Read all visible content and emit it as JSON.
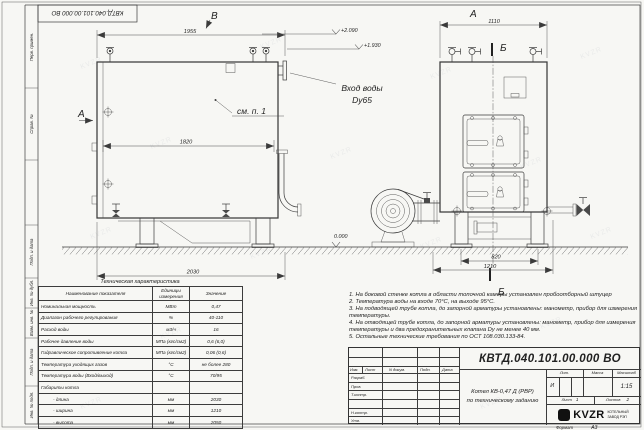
{
  "sheet": {
    "stamp_code": "КВТД.040.101.00.000 ВО",
    "format_label": "Формат",
    "format_value": "А3",
    "watermark": "KVZR",
    "margin_labels": {
      "perv_primen": "Перв. примен.",
      "sprav_no": "Справ. №",
      "podp_data_1": "Подп. и дата",
      "inv_dubl": "Инв. № дубл.",
      "vzam_inv": "Взам. инв. №",
      "podp_data_2": "Подп. и дата",
      "inv_podl": "Инв. № подл."
    }
  },
  "drawing": {
    "view_top_label": "В",
    "view_front_arrow_label": "А",
    "view_side_label": "А",
    "section_label_top": "Б",
    "section_label_bottom": "Б",
    "callout": "см. п. 1",
    "inlet_line1": "Вход воды",
    "inlet_line2": "Dy65",
    "elev_top": "+2.090",
    "elev_mid": "+1.930",
    "elev_zero": "0.000",
    "dim_1955": "1955",
    "dim_1820": "1820",
    "dim_2030": "2030",
    "dim_1110": "1110",
    "dim_820": "820",
    "dim_1210": "1210"
  },
  "spec_table": {
    "title": "Техническая характеристика",
    "headers": [
      "Наименование показателя",
      "Единицы измерения",
      "Значение"
    ],
    "rows": [
      [
        "Номинальная мощность",
        "МВт",
        "0,47"
      ],
      [
        "Диапазон рабочего регулирования",
        "%",
        "40-110"
      ],
      [
        "Расход воды",
        "м3/ч",
        "16"
      ],
      [
        "Рабочее давление воды",
        "МПа (кгс/см2)",
        "0,6 (6,0)"
      ],
      [
        "Гидравлическое сопротивление котла",
        "МПа (кгс/см2)",
        "0,06 (0,6)"
      ],
      [
        "Температура уходящих газов",
        "°С",
        "не более 280"
      ],
      [
        "Температура воды (Вход/выход)",
        "°С",
        "70/95"
      ],
      [
        "Габариты котла",
        "",
        ""
      ],
      [
        "- длина",
        "мм",
        "2030"
      ],
      [
        "- ширина",
        "мм",
        "1210"
      ],
      [
        "- высота",
        "мм",
        "2050"
      ]
    ]
  },
  "notes": [
    "1. На боковой стенке котла в области топочной камеры установлен пробоотборный штуцер",
    "2. Температура воды на входе 70°С, на выходе 95°С.",
    "3. На подводящей трубе котла, до запорной арматуры установлены: манометр, прибор для измерения температуры.",
    "4. На отводящей трубе котла, до запорной арматуры установлены: манометр, прибор для измерения температуры и два предохранительных клапана Dу не менее 40 мм.",
    "5. Остальные технические требования по ОСТ 108.030.133-84."
  ],
  "title_block": {
    "doc_number": "КВТД.040.101.00.000 ВО",
    "header_cells": [
      "Изм.",
      "Лист",
      "N докум.",
      "Подп.",
      "Дата"
    ],
    "roles": [
      "Разраб.",
      "Пров.",
      "Т.контр.",
      "",
      "Н.контр.",
      "Утв."
    ],
    "title_line1": "Котел КВ-0,47 Д (РВР)",
    "title_line2": "по техническому заданию",
    "lit_label": "Лит.",
    "lit_value": "И",
    "mass_label": "Масса",
    "scale_label": "Масштаб",
    "scale_value": "1:15",
    "sheet_label": "Лист",
    "sheet_value": "1",
    "sheets_label": "Листов",
    "sheets_value": "2",
    "company": "KVZR",
    "company_sub1": "КОТЕЛЬНЫЙ",
    "company_sub2": "ЗАВОД РЭП"
  }
}
